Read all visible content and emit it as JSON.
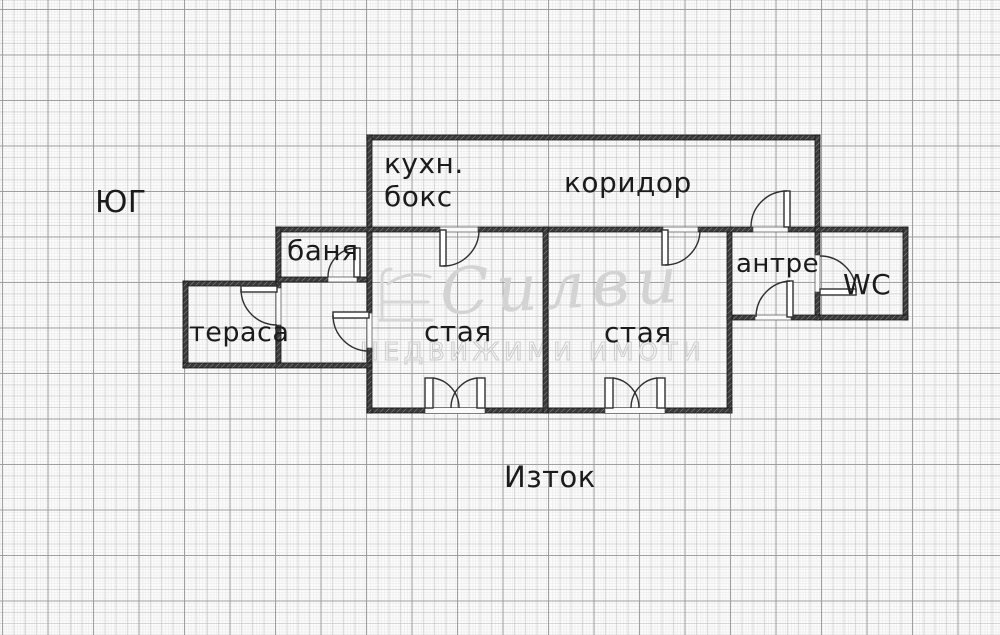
{
  "compass": {
    "south_label": "ЮГ",
    "east_label": "Изток"
  },
  "rooms": {
    "kitchen_line1": "кухн.",
    "kitchen_line2": "бокс",
    "corridor": "коридор",
    "bath": "баня",
    "terrace": "тераса",
    "room_left": "стая",
    "room_right": "стая",
    "hall": "антре",
    "wc": "WC"
  },
  "watermark": {
    "brand_script": "Силви",
    "brand_caption": "НЕДВИЖИМИ ИМОТИ"
  },
  "colors": {
    "background": "#fcfcfc",
    "grid_major": "#969696",
    "grid_minor": "#c9c9c9",
    "wall": "#3a3a3a",
    "line": "#2f2f2f",
    "text": "#1b1b1b",
    "watermark": "#d3d3d3"
  }
}
